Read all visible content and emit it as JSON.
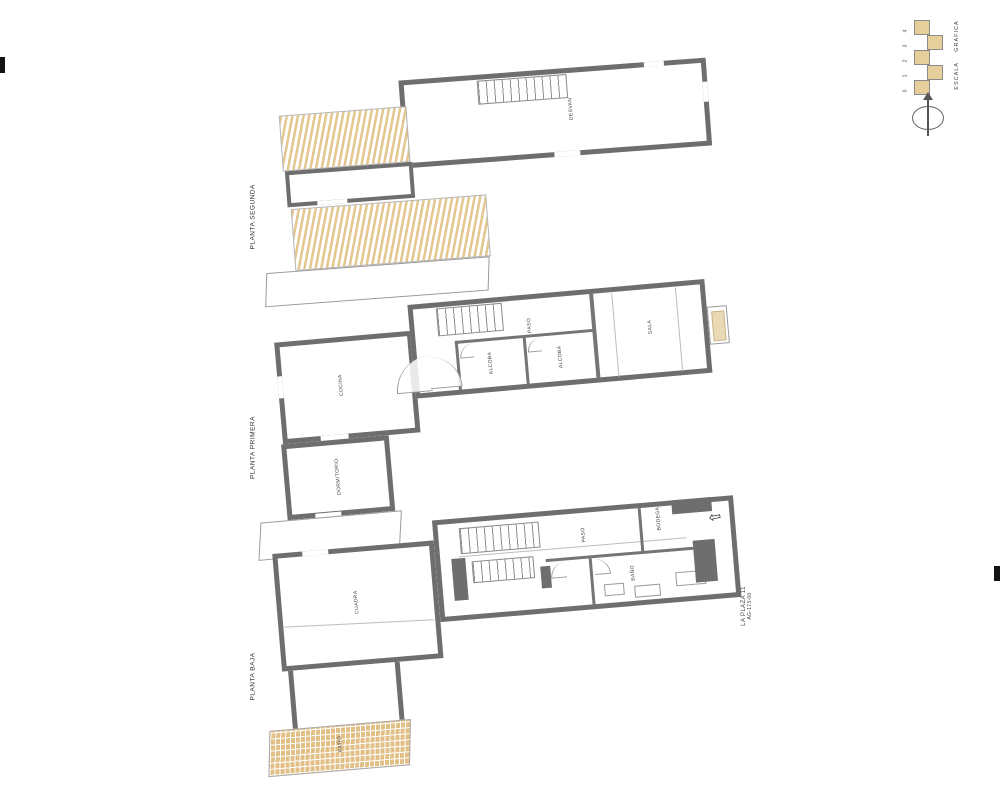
{
  "sheet": {
    "type_note": "scanned architectural floor plan sheet, rotated 90deg CCW",
    "background": "#ffffff"
  },
  "colors": {
    "wall": "#6e6e6e",
    "roof_hatch": "#e4c68f",
    "patio_hatch": "#e2bf84",
    "sill": "#ead9b5",
    "ink": "#3f3f3f"
  },
  "plans": {
    "segunda": {
      "title": "PLANTA SEGUNDA",
      "rooms": {
        "desvan": "DESVAN"
      }
    },
    "primera": {
      "title": "PLANTA PRIMERA",
      "rooms": {
        "cocina": "COCINA",
        "dormitorio": "DORMITORIO",
        "paso": "PASO",
        "alcoba1": "ALCOBA",
        "alcoba2": "ALCOBA",
        "sala": "SALA"
      }
    },
    "baja": {
      "title": "PLANTA BAJA",
      "rooms": {
        "cuadra": "CUADRA",
        "paso": "PASO",
        "bano": "BAÑO",
        "bodega": "BODEGA",
        "patio": "PATIO"
      }
    }
  },
  "titleblock": {
    "address": "LA PLAZA 11",
    "reference": "AG-173-00"
  },
  "scale_bar": {
    "label": "ESCALA GRAFICA",
    "ticks": [
      "0",
      "1",
      "2",
      "3",
      "4"
    ]
  }
}
